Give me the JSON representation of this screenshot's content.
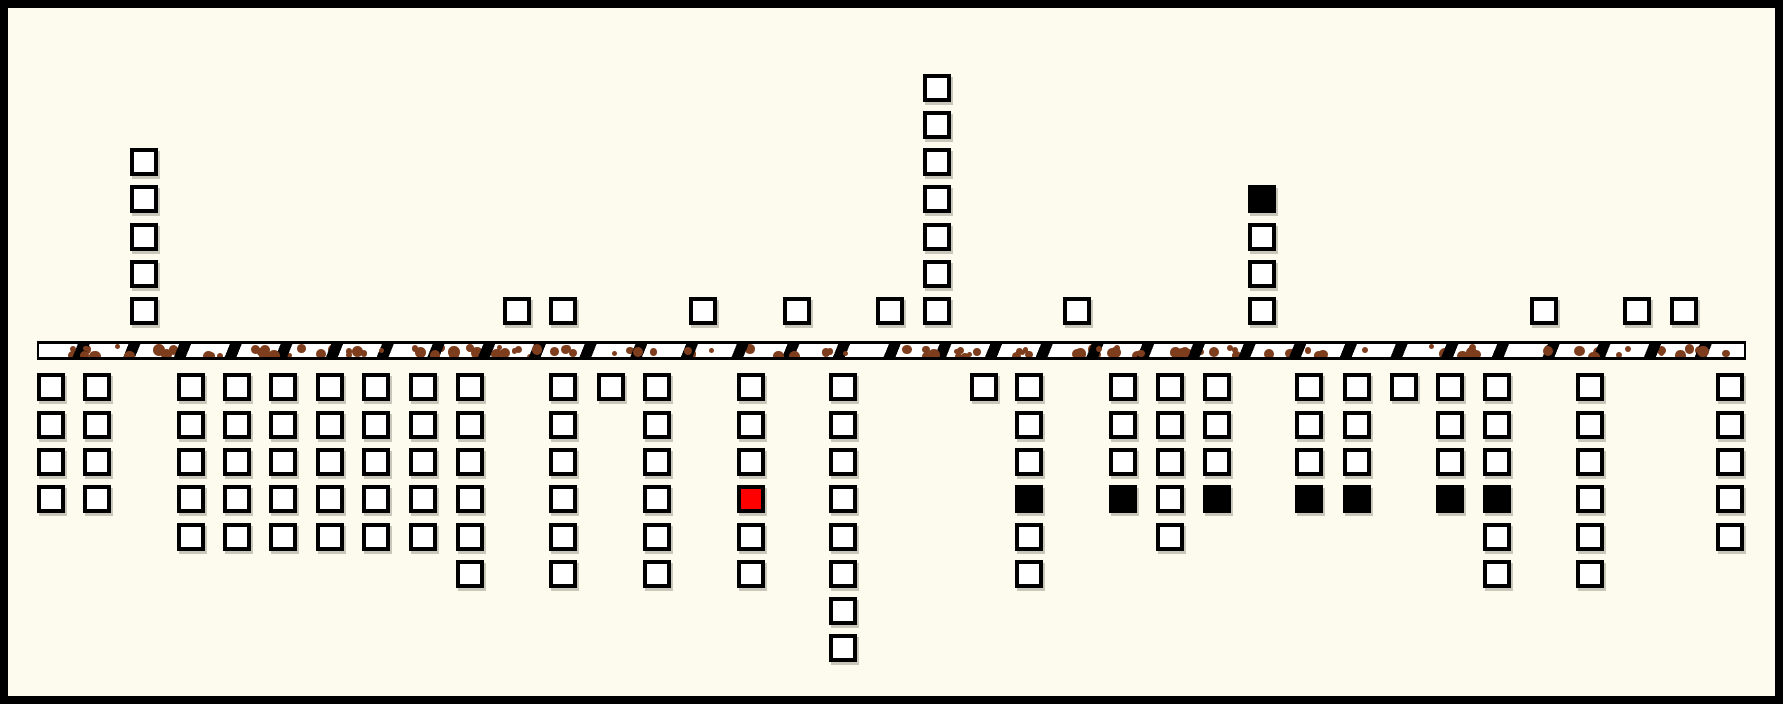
{
  "figure": {
    "description": "Diagram of square markers stacked in columns above and below a hatched, speckled horizontal band",
    "colors": {
      "background": "#FCFBED",
      "frame": "#000000",
      "square_border": "#000000",
      "fill_codes": {
        "w": "#FFFFFF",
        "k": "#000000",
        "r": "#FF0000"
      },
      "band_fill": "#FFFFFF",
      "band_border": "#000000",
      "band_hatch": "#000000",
      "band_speckle": "#7E3E1D"
    },
    "layout": {
      "width": 1783,
      "height": 704,
      "frame_border": 8,
      "square_size": 28,
      "row_pitch": 37.3,
      "above_base_top_y": 297.3,
      "below_start_top_y": 373.3,
      "band": {
        "x": 37,
        "y": 341,
        "width": 1709,
        "height": 19
      },
      "hatch_period": 47,
      "hatch_stroke": 11,
      "hatch_angle_deg": 112,
      "speckle_count": 130,
      "speckle_seed": 42
    },
    "columns_above": [
      {
        "x": 130,
        "squares": [
          "w",
          "w",
          "w",
          "w",
          "w"
        ]
      },
      {
        "x": 503,
        "squares": [
          "w"
        ]
      },
      {
        "x": 549,
        "squares": [
          "w"
        ]
      },
      {
        "x": 689,
        "squares": [
          "w"
        ]
      },
      {
        "x": 783,
        "squares": [
          "w"
        ]
      },
      {
        "x": 876,
        "squares": [
          "w"
        ]
      },
      {
        "x": 923,
        "squares": [
          "w",
          "w",
          "w",
          "w",
          "w",
          "w",
          "w"
        ]
      },
      {
        "x": 1063,
        "squares": [
          "w"
        ]
      },
      {
        "x": 1248,
        "squares": [
          "w",
          "w",
          "w",
          "k"
        ]
      },
      {
        "x": 1530,
        "squares": [
          "w"
        ]
      },
      {
        "x": 1623,
        "squares": [
          "w"
        ]
      },
      {
        "x": 1670,
        "squares": [
          "w"
        ]
      }
    ],
    "columns_below": [
      {
        "x": 37,
        "squares": [
          "w",
          "w",
          "w",
          "w"
        ]
      },
      {
        "x": 83,
        "squares": [
          "w",
          "w",
          "w",
          "w"
        ]
      },
      {
        "x": 177,
        "squares": [
          "w",
          "w",
          "w",
          "w",
          "w"
        ]
      },
      {
        "x": 223,
        "squares": [
          "w",
          "w",
          "w",
          "w",
          "w"
        ]
      },
      {
        "x": 269,
        "squares": [
          "w",
          "w",
          "w",
          "w",
          "w"
        ]
      },
      {
        "x": 316,
        "squares": [
          "w",
          "w",
          "w",
          "w",
          "w"
        ]
      },
      {
        "x": 362,
        "squares": [
          "w",
          "w",
          "w",
          "w",
          "w"
        ]
      },
      {
        "x": 409,
        "squares": [
          "w",
          "w",
          "w",
          "w",
          "w"
        ]
      },
      {
        "x": 456,
        "squares": [
          "w",
          "w",
          "w",
          "w",
          "w",
          "w"
        ]
      },
      {
        "x": 549,
        "squares": [
          "w",
          "w",
          "w",
          "w",
          "w",
          "w"
        ]
      },
      {
        "x": 597,
        "squares": [
          "w"
        ]
      },
      {
        "x": 643,
        "squares": [
          "w",
          "w",
          "w",
          "w",
          "w",
          "w"
        ]
      },
      {
        "x": 737,
        "squares": [
          "w",
          "w",
          "w",
          "r",
          "w",
          "w"
        ]
      },
      {
        "x": 829,
        "squares": [
          "w",
          "w",
          "w",
          "w",
          "w",
          "w",
          "w",
          "w"
        ]
      },
      {
        "x": 970,
        "squares": [
          "w"
        ]
      },
      {
        "x": 1015,
        "squares": [
          "w",
          "w",
          "w",
          "k",
          "w",
          "w"
        ]
      },
      {
        "x": 1109,
        "squares": [
          "w",
          "w",
          "w",
          "k"
        ]
      },
      {
        "x": 1156,
        "squares": [
          "w",
          "w",
          "w",
          "w",
          "w"
        ]
      },
      {
        "x": 1203,
        "squares": [
          "w",
          "w",
          "w",
          "k"
        ]
      },
      {
        "x": 1295,
        "squares": [
          "w",
          "w",
          "w",
          "k"
        ]
      },
      {
        "x": 1343,
        "squares": [
          "w",
          "w",
          "w",
          "k"
        ]
      },
      {
        "x": 1390,
        "squares": [
          "w"
        ]
      },
      {
        "x": 1436,
        "squares": [
          "w",
          "w",
          "w",
          "k"
        ]
      },
      {
        "x": 1483,
        "squares": [
          "w",
          "w",
          "w",
          "k",
          "w",
          "w"
        ]
      },
      {
        "x": 1576,
        "squares": [
          "w",
          "w",
          "w",
          "w",
          "w",
          "w"
        ]
      },
      {
        "x": 1716,
        "squares": [
          "w",
          "w",
          "w",
          "w",
          "w"
        ]
      }
    ]
  }
}
